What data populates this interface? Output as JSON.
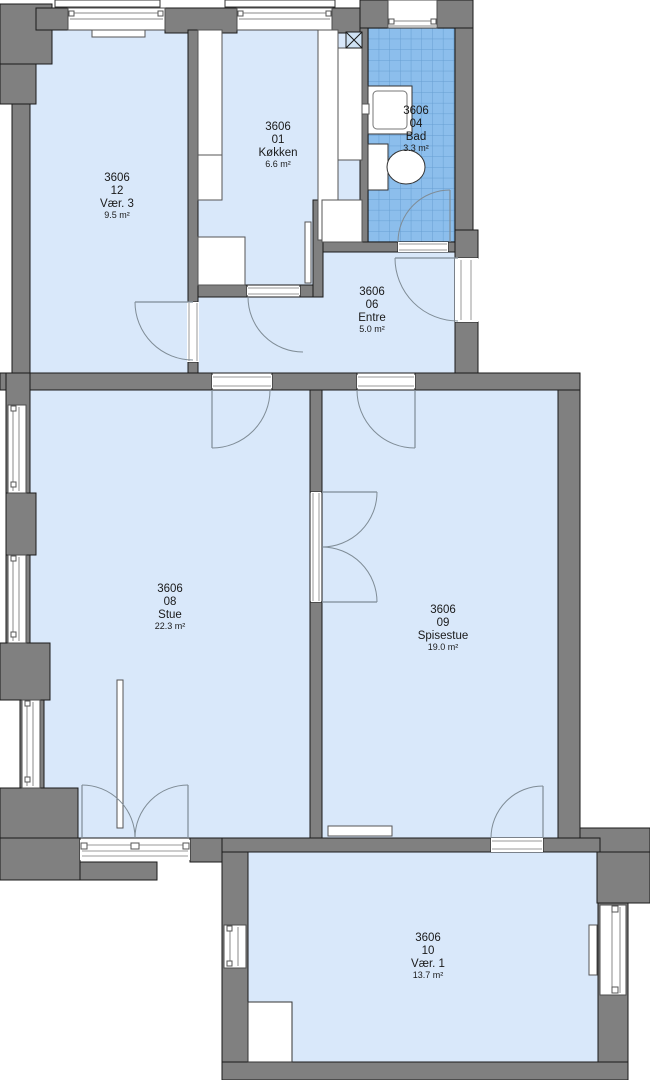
{
  "rooms": [
    {
      "id": "3606",
      "unit": "12",
      "name": "Vær. 3",
      "area": "9.5 m²"
    },
    {
      "id": "3606",
      "unit": "01",
      "name": "Køkken",
      "area": "6.6 m²"
    },
    {
      "id": "3606",
      "unit": "04",
      "name": "Bad",
      "area": "3.3 m²"
    },
    {
      "id": "3606",
      "unit": "06",
      "name": "Entre",
      "area": "5.0 m²"
    },
    {
      "id": "3606",
      "unit": "08",
      "name": "Stue",
      "area": "22.3 m²"
    },
    {
      "id": "3606",
      "unit": "09",
      "name": "Spisestue",
      "area": "19.0 m²"
    },
    {
      "id": "3606",
      "unit": "10",
      "name": "Vær. 1",
      "area": "13.7 m²"
    }
  ],
  "colors": {
    "wall_fill": "#808080",
    "outline": "#1a1a1a",
    "room_fill": "#d9e8fa",
    "tile_fill": "#8cbeec",
    "tile_line": "#679fd2",
    "door_arc": "#7f8c96"
  }
}
